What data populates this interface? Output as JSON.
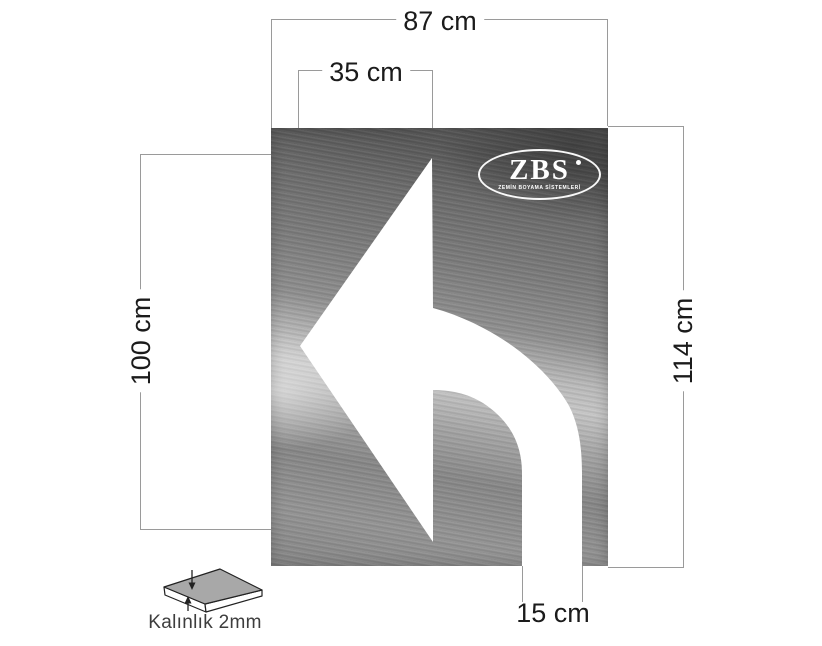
{
  "canvas": {
    "width": 822,
    "height": 646,
    "background": "#ffffff"
  },
  "diagram": {
    "subject": "turn-left-arrow-stencil-plate",
    "labels": {
      "plate_width": "87 cm",
      "arrow_head_width": "35 cm",
      "arrow_height": "100 cm",
      "plate_height": "114 cm",
      "tail_width": "15 cm",
      "thickness_caption": "Kalınlık 2mm"
    }
  },
  "logo": {
    "name": "ZBS",
    "tagline": "ZEMİN BOYAMA SİSTEMLERİ"
  },
  "colors": {
    "dimension_line": "#9a9a9a",
    "dimension_text": "#1b1b1b",
    "caption_text": "#3d3d3d",
    "arrow_fill": "#ffffff",
    "plate_dark": "#585858",
    "plate_light": "#c7c7c7",
    "logo_white": "#ffffff",
    "slab_top_fill": "#a8a8a8",
    "slab_outline": "#222222"
  }
}
